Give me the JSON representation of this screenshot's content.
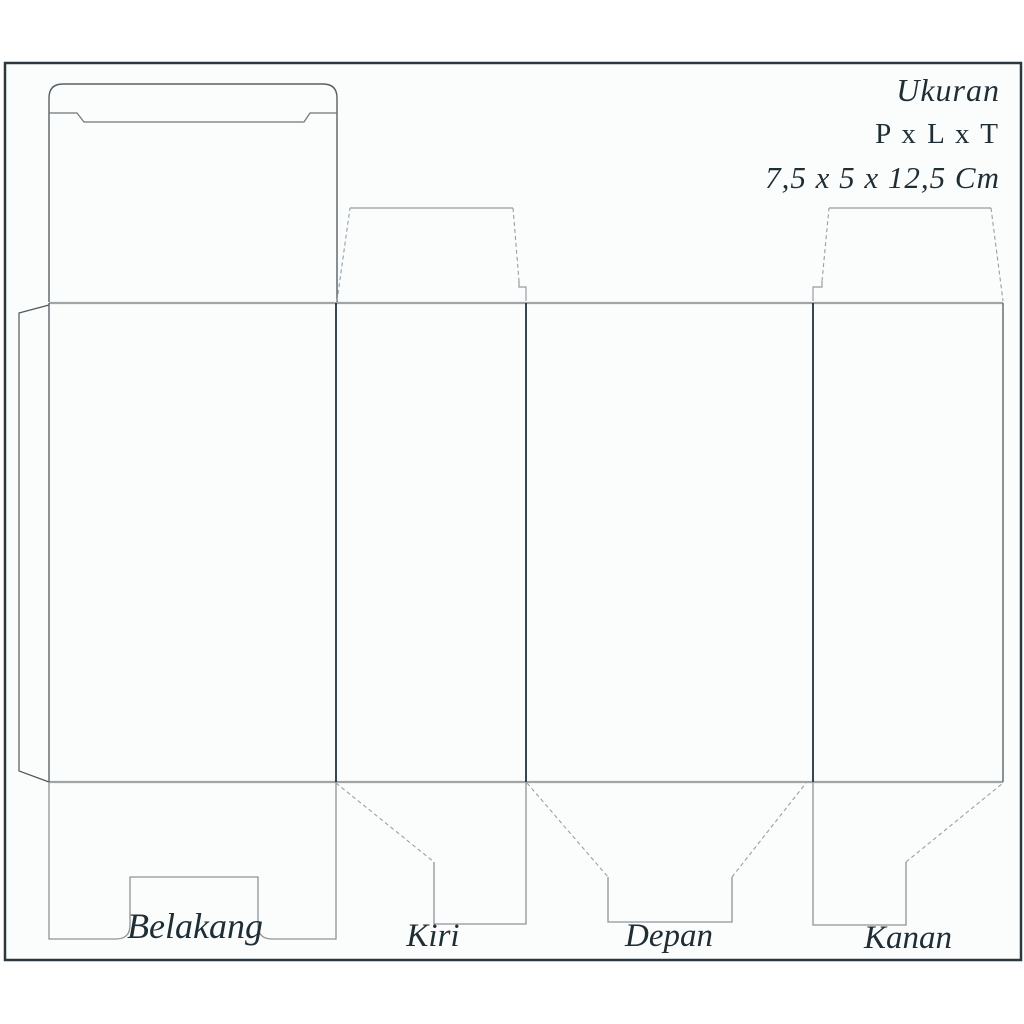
{
  "size_info": {
    "heading": "Ukuran",
    "formula": "P x L x T",
    "dimensions": "7,5 x 5 x 12,5 Cm"
  },
  "panel_labels": {
    "back": "Belakang",
    "left": "Kiri",
    "front": "Depan",
    "right": "Kanan"
  },
  "dimensions_cm": {
    "panjang": "7,5",
    "lebar": "5",
    "tinggi": "12,5"
  },
  "colors": {
    "frame_border": "#2d383e",
    "inner_background": "#fbfdfd",
    "fold_line_gray": "#9fa5a8",
    "panel_divider_dark": "#25313a",
    "flap_outline_gray": "#8e9497",
    "text": "#1f2d35"
  }
}
